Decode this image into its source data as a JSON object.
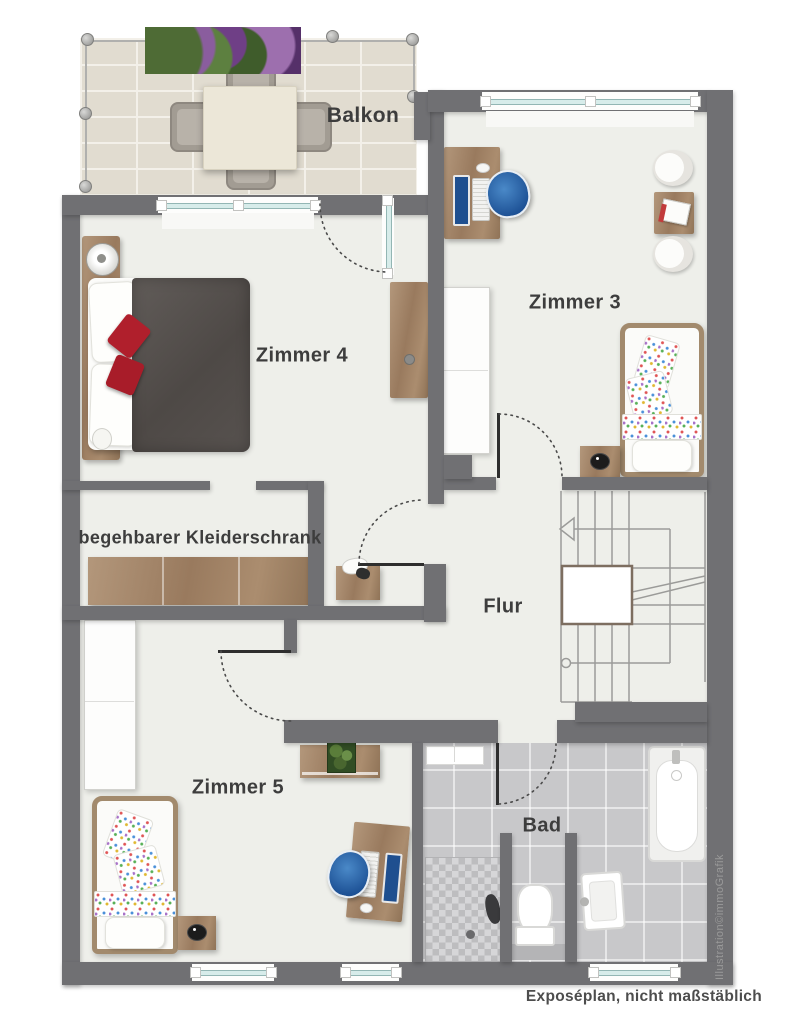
{
  "plan": {
    "caption": "Exposéplan, nicht maßstäblich",
    "watermark": "Illustration©immoGrafik"
  },
  "rooms": [
    {
      "id": "balkon",
      "label": "Balkon"
    },
    {
      "id": "zimmer3",
      "label": "Zimmer 3"
    },
    {
      "id": "zimmer4",
      "label": "Zimmer 4"
    },
    {
      "id": "kleiderschrank",
      "label": "begehbarer Kleiderschrank"
    },
    {
      "id": "flur",
      "label": "Flur"
    },
    {
      "id": "zimmer5",
      "label": "Zimmer 5"
    },
    {
      "id": "bad",
      "label": "Bad"
    }
  ],
  "colors": {
    "wall": "#707073",
    "floor": "#eeefea",
    "balcony_tile": "#e1dcd0",
    "bathroom_tile": "#c8c8ca",
    "wood": "#a3876a",
    "window_glass": "#d7ecea",
    "bed_duvet": "#57524f",
    "accent_red": "#b01f2c",
    "accent_blue": "#2d6fb7",
    "label_text": "#3d3d3d",
    "watermark_text": "#9a9a9a"
  }
}
